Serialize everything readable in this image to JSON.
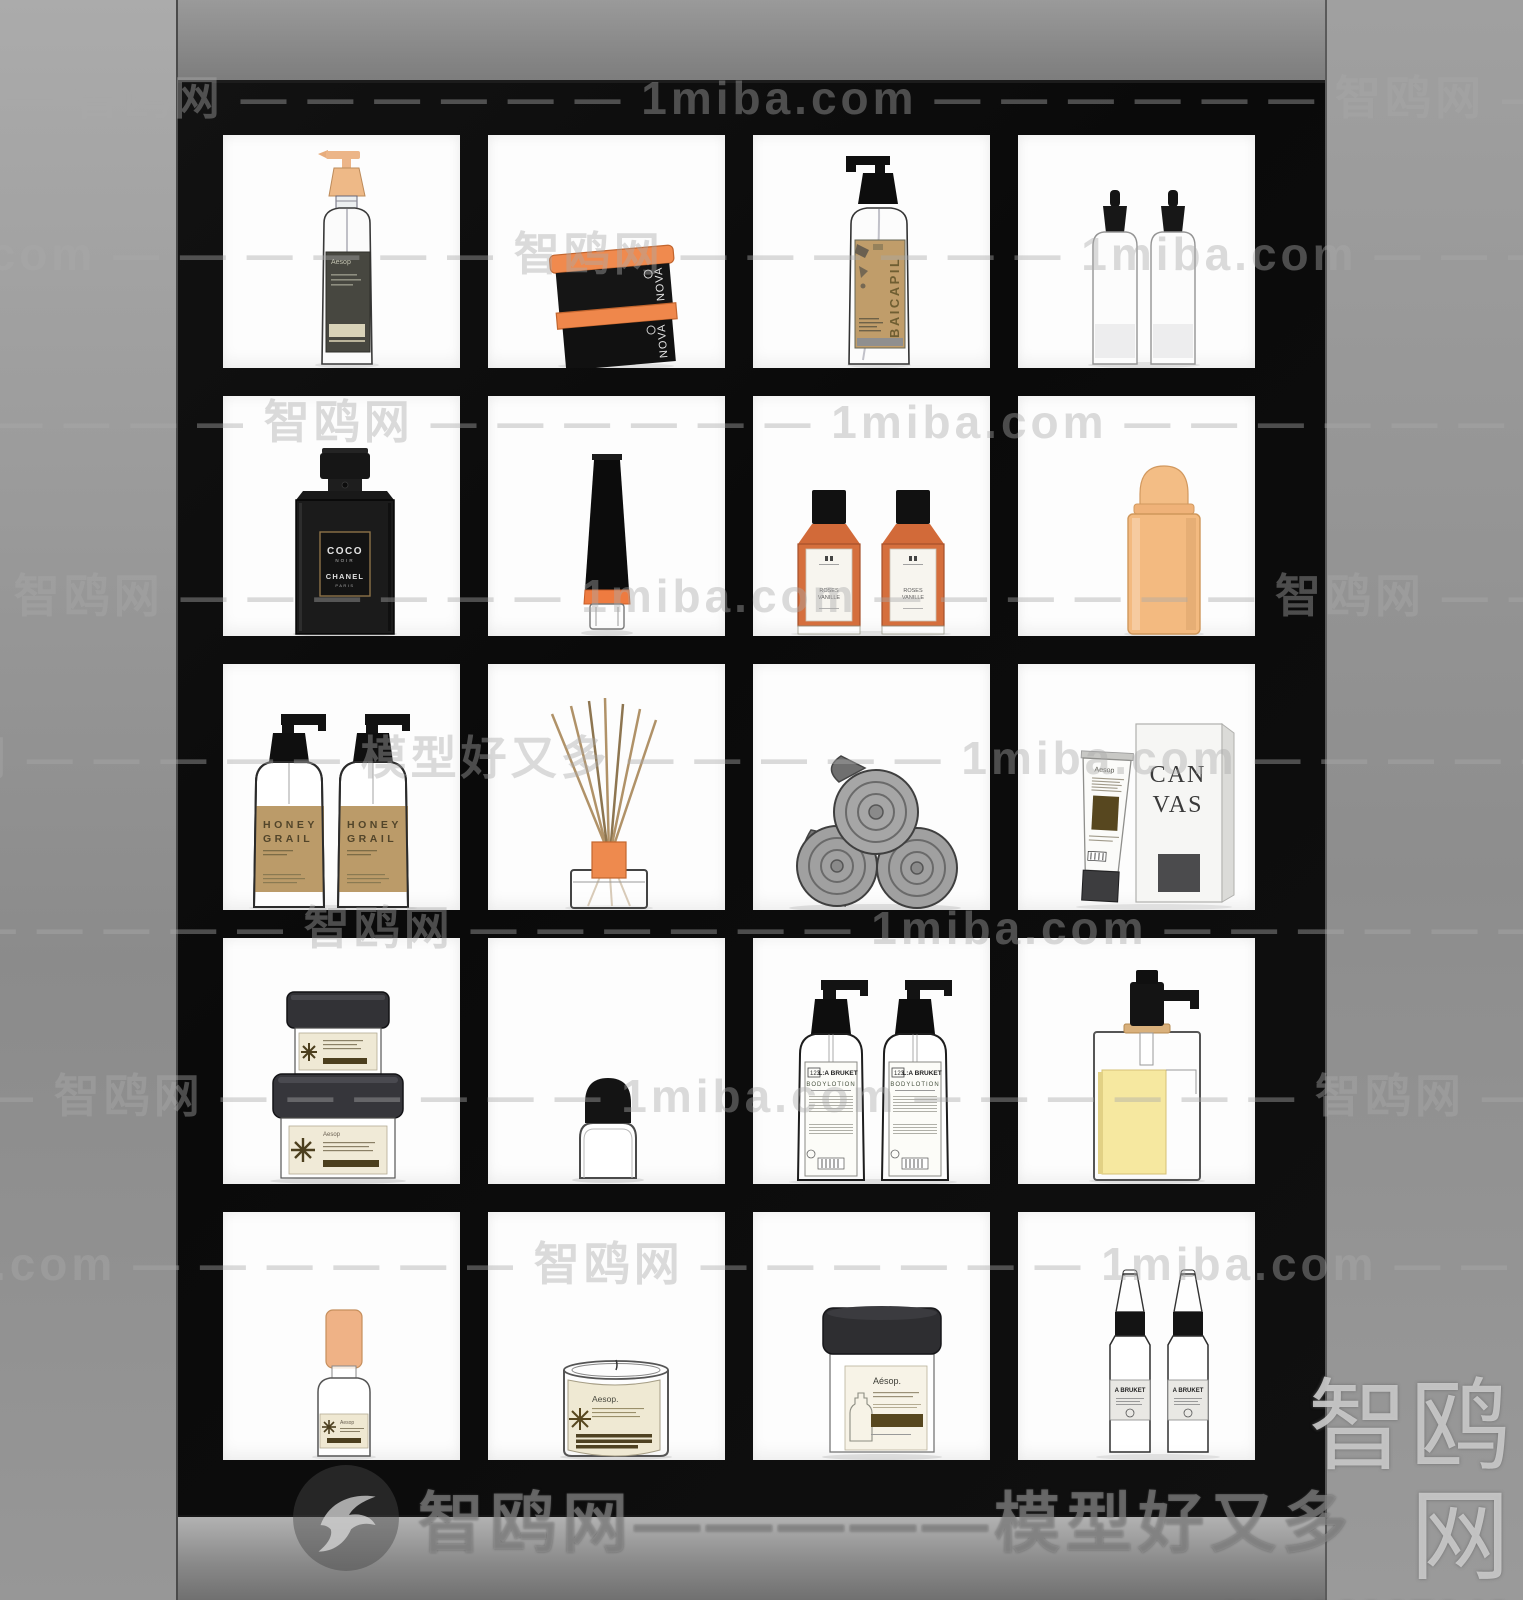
{
  "watermarks": {
    "pattern_a": "1miba.com — — — — — — 智鸥网 — — — — — — 1miba.com — — — — — — 智鸥网 — — — — — —",
    "pattern_b": "智鸥网 — — — — — 模型好又多 — — — — — 1miba.com — — — — — 智鸥网 — — — — —",
    "banner": "智鸥网—————模型好又多",
    "corner_brand": "智鸥网",
    "id_text": "ID:696907043"
  },
  "products": {
    "aesop_small": "Aesop",
    "nova": "NOVA",
    "baicapil": "BAICAPIL",
    "coco": "COCO",
    "noir": "NOIR",
    "chanel": "CHANEL",
    "paris": "PARIS",
    "roses": "ROSES",
    "vanille": "VANILLE",
    "honey": "HONEY",
    "grail": "GRAIL",
    "can": "CAN",
    "vas": "VAS",
    "bruket_no": "123",
    "bruket_brand": "L:A BRUKET",
    "bodylotion": "BODYLOTION",
    "aesop_jar": "Aésop.",
    "aesop_candle": "Aesop.",
    "a_bruket": "A BRUKET"
  },
  "colors": {
    "accent_orange": "#ef8a4e",
    "pump_tan": "#eeb987",
    "kraft_label": "#bb9b69",
    "cream_label": "#efe9d5",
    "liquid_yellow": "#f6e8a0",
    "cabinet_black": "#0c0c0c",
    "wall_gray": "#989898"
  }
}
